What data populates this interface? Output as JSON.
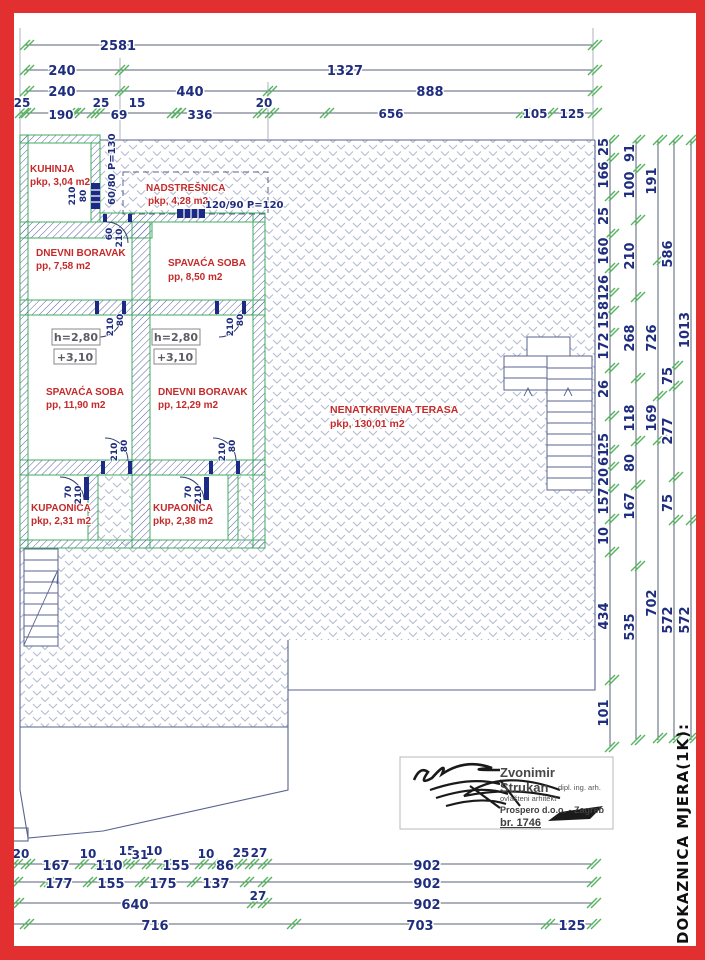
{
  "colors": {
    "border_red": "#e23030",
    "dim_text_navy": "#1f2d7e",
    "room_label_red": "#c42a2a",
    "wall_green": "#3fae5f",
    "tick_green": "#55b45e",
    "terrace_hatch": "#b4bbd2"
  },
  "dims": {
    "top": {
      "r1": [
        "2581"
      ],
      "r2": [
        "240",
        "1327"
      ],
      "r3": [
        "240",
        "440",
        "888"
      ],
      "r4": [
        "25",
        "190",
        "25",
        "69",
        "15",
        "336",
        "20",
        "656",
        "105",
        "125"
      ]
    },
    "right": {
      "c1": [
        "25",
        "166",
        "25",
        "160",
        "26",
        "81",
        "15",
        "172",
        "26",
        "25",
        "61",
        "20",
        "157",
        "10",
        "434",
        "101"
      ],
      "c2": [
        "91",
        "100",
        "210",
        "268",
        "118",
        "80",
        "167",
        "535"
      ],
      "c3": [
        "191",
        "726",
        "169",
        "702"
      ],
      "c4": [
        "586",
        "75",
        "277",
        "75",
        "572"
      ],
      "c5": [
        "1013",
        "572"
      ]
    },
    "bottom": {
      "r1": [
        "20",
        "167",
        "10",
        "110",
        "15",
        "31",
        "10",
        "155",
        "10",
        "86",
        "25",
        "27",
        "902"
      ],
      "r2": [
        "177",
        "155",
        "175",
        "137",
        "27",
        "902"
      ],
      "r3": [
        "640",
        "902"
      ],
      "r4": [
        "716",
        "703",
        "125"
      ]
    }
  },
  "plan": {
    "rooms": [
      {
        "label": "KUHINJA",
        "area": "pkp, 3,04 m2"
      },
      {
        "label": "NADSTREŠNICA",
        "area": "pkp, 4,28 m2"
      },
      {
        "label": "DNEVNI BORAVAK",
        "area": "pp, 7,58 m2"
      },
      {
        "label": "SPAVAĆA SOBA",
        "area": "pp, 8,50 m2"
      },
      {
        "label": "SPAVAĆA SOBA",
        "area": "pp, 11,90 m2"
      },
      {
        "label": "DNEVNI BORAVAK",
        "area": "pp, 12,29 m2"
      },
      {
        "label": "NENATKRIVENA TERASA",
        "area": "pkp, 130,01 m2"
      },
      {
        "label": "KUPAONICA",
        "area": "pkp, 2,31 m2"
      },
      {
        "label": "KUPAONICA",
        "area": "pkp, 2,38 m2"
      }
    ],
    "height_label": "h=2,80",
    "level_label": "+3,10",
    "window1": "60/80 P=130",
    "window2": "120/90 P=120",
    "marks": {
      "m60": "60",
      "m70": "70",
      "m80": "80",
      "m210": "210"
    },
    "frag0": "0",
    "fragA": "A"
  },
  "title_block": {
    "name1": "Zvonimir",
    "name2": "Strukan",
    "cred": "dipl. ing. arh.",
    "role": "ovlašteni arhitekt",
    "firm": "Prospero d.o.o. - Zagreb",
    "num": "br. 1746"
  },
  "side_note": "DOKAZNICA MJERA(1K):"
}
